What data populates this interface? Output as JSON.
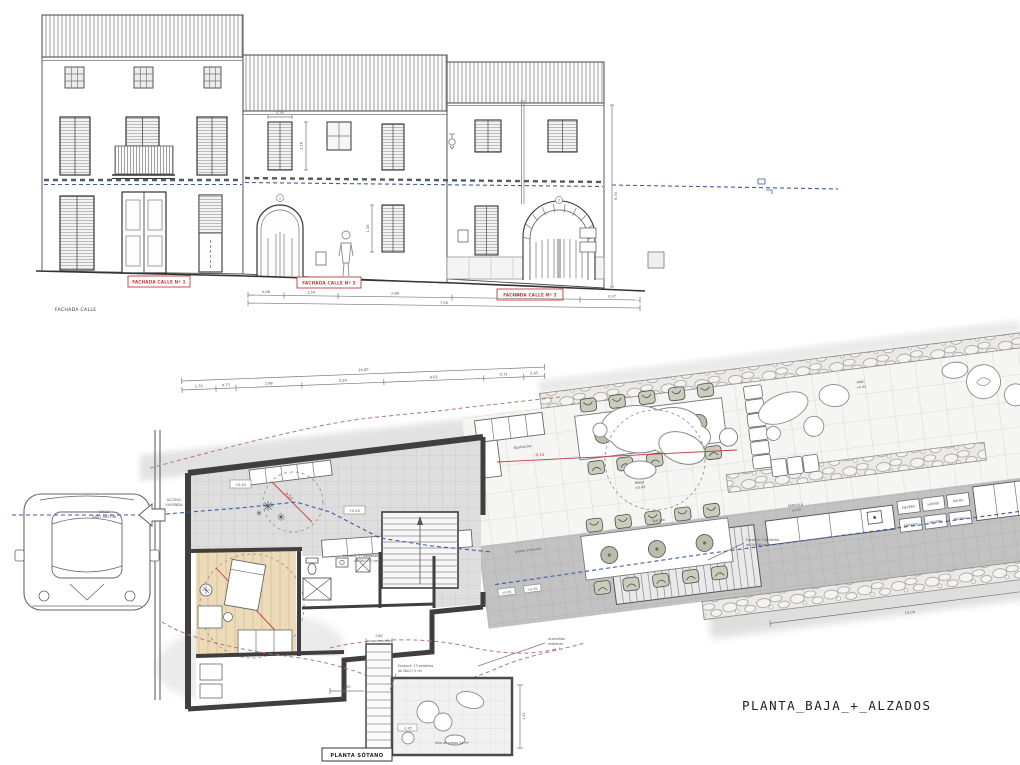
{
  "sheet": {
    "title": "PLANTA_BAJA_+_ALZADOS"
  },
  "colors": {
    "accent_red": "#c23b3b",
    "line_blue": "#3b5fa0"
  },
  "elevations": {
    "caption": "FACHADA CALLE",
    "facade1": "FACHADA CALLE Nº 1",
    "facade2": "FACHADA CALLE Nº 2",
    "facade3": "FACHADA CALLE Nº 3",
    "door_number_2": "1",
    "door_number_3": "2",
    "dim_window_width": "0,90",
    "dim_window_height_a": "1,18",
    "dim_window_height_b": "1,16",
    "dim_facade_height": "6,30",
    "chain": [
      "0,68",
      "1,54",
      "2,88",
      "2,43",
      "0,37"
    ],
    "chain_total": "7,90"
  },
  "plan": {
    "access_line1": "ACCESO",
    "access_line2": "VIVIENDA",
    "street_line1": "CALLE",
    "street_line2": "SANT ANTONI",
    "top_chain": [
      "1,35",
      "0,73",
      "2,98",
      "3,29",
      "4,02",
      "0,72",
      "2,45"
    ],
    "top_total": "14,60",
    "level_entry": "+0.40",
    "level_salon": "+0.45",
    "level_terrace_a": "+0.05",
    "level_terrace_b": "+0.05",
    "red_dim_entry": "4,50",
    "red_dim_bedroom": "6,40",
    "red_dim_patio": "8,15",
    "stair_note_line1": "Escalera: 17 peldaños",
    "stair_note_line2": "de 28x17,5 cm",
    "patio_stair_note_line1": "Escalera: 7 peldaños",
    "patio_stair_note_line2": "de 30x16 cm",
    "label_terraza": "Terraza",
    "label_mesa_line1": "Mesa",
    "label_mesa_line2": "+0.45",
    "label_barbacoa": "Barbacoa",
    "label_piedra": "piedra existente",
    "label_pergola_line1": "PÉRGOLA",
    "label_pergola_line2": "+0.50",
    "label_pino_line1": "PINO",
    "label_pino_line2": "+0.45",
    "kitchen_units": [
      "NEVERA",
      "HORNO",
      "MICRO",
      "ARMARIO",
      "NEVERA",
      "BODEGA"
    ],
    "dim_garden_bottom": "15,04",
    "acometida_line1": "acometida",
    "acometida_line2": "existente"
  },
  "basement": {
    "caption": "PLANTA SÓTANO",
    "room_label": "Sala de juegos 48 m²",
    "stair_note_line1": "Escalera: 13 peldaños",
    "stair_note_line2": "de 28x17,5 cm",
    "level": "-2,45",
    "dim_height": "2,45",
    "dim_width": "0,80",
    "dim_left": "1,50"
  }
}
